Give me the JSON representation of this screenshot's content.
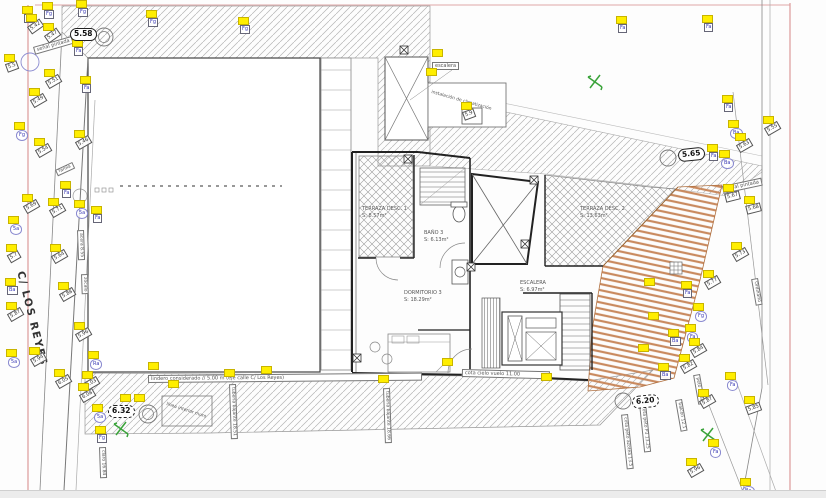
{
  "title": "Plano planta - levantamiento topográfico",
  "street": {
    "label": "C/ LOS REYES"
  },
  "rooms": [
    {
      "name": "TERRAZA DESC. 1",
      "area": "S: 8.57m²"
    },
    {
      "name": "BAÑO 3",
      "area": "S: 6.13m²"
    },
    {
      "name": "DORMITORIO 3",
      "area": "S: 18.29m²"
    },
    {
      "name": "ESCALERA",
      "area": "S: 6.97m²"
    },
    {
      "name": "TERRAZA DESC. 2",
      "area": "S: 13.63m²"
    }
  ],
  "benchmarks": [
    {
      "value": "5.58"
    },
    {
      "value": "5.65"
    },
    {
      "value": "6.32"
    },
    {
      "value": "6.20"
    }
  ],
  "colors": {
    "flag": "#ffee00",
    "deck": "#c98a5f",
    "station": "#3aa33a",
    "boundary": "#dc9a9a",
    "code_blue": "#3b3bb5"
  },
  "annotations": [
    {
      "t": "señal pintada",
      "x": 33,
      "y": 47,
      "r": -16,
      "box": 1,
      "fs": 5
    },
    {
      "t": "señal pintada",
      "x": 722,
      "y": 186,
      "r": -12,
      "box": 1,
      "fs": 5
    },
    {
      "t": "escalera",
      "x": 432,
      "y": 62,
      "r": 0,
      "box": 1,
      "fs": 5
    },
    {
      "t": "instalación de climatización",
      "x": 432,
      "y": 90,
      "r": 16,
      "box": 0,
      "fs": 4.5,
      "w": 66
    },
    {
      "t": "zócalo",
      "x": 88,
      "y": 274,
      "r": 88,
      "box": 1,
      "fs": 4.5
    },
    {
      "t": "farola",
      "x": 55,
      "y": 170,
      "r": -25,
      "box": 1,
      "fs": 4.5
    },
    {
      "t": "Ordinario",
      "x": 758,
      "y": 278,
      "r": 80,
      "box": 1,
      "fs": 4.5
    },
    {
      "t": "acera 8.55",
      "x": 84,
      "y": 230,
      "r": 88,
      "box": 1,
      "fs": 4.5
    },
    {
      "t": "lindero considerado // 5.00 m (eje calle C/ Los Reyes)",
      "x": 148,
      "y": 375,
      "r": -0.5,
      "box": 1,
      "fs": 5,
      "w": 268
    },
    {
      "t": "cota cielo vuelo 11.00",
      "x": 462,
      "y": 369,
      "r": 1.5,
      "box": 1,
      "fs": 5,
      "w": 82
    },
    {
      "t": "tubería bajante 18.51",
      "x": 236,
      "y": 384,
      "r": 88,
      "box": 1,
      "fs": 4.5
    },
    {
      "t": "tubería bajante 18.66",
      "x": 390,
      "y": 388,
      "r": 88,
      "box": 1,
      "fs": 4.5
    },
    {
      "t": "claro 16.84",
      "x": 106,
      "y": 447,
      "r": 88,
      "box": 1,
      "fs": 4.5
    },
    {
      "t": "cota peto azotea 13.5",
      "x": 628,
      "y": 414,
      "r": 84,
      "box": 1,
      "fs": 4.5
    },
    {
      "t": "cota peto P3 13.25",
      "x": 646,
      "y": 403,
      "r": 84,
      "box": 1,
      "fs": 4.5
    },
    {
      "t": "peto 12.38",
      "x": 700,
      "y": 374,
      "r": 80,
      "box": 1,
      "fs": 4.5
    },
    {
      "t": "balcón 12.1",
      "x": 682,
      "y": 399,
      "r": 80,
      "box": 1,
      "fs": 4.5
    },
    {
      "t": "línea interior muro",
      "x": 167,
      "y": 402,
      "r": 18,
      "box": 0,
      "fs": 4.5
    }
  ],
  "survey_points": [
    {
      "x": 24,
      "y": 14,
      "t": "Ba",
      "s": "code",
      "r": 0
    },
    {
      "x": 44,
      "y": 10,
      "t": "Fg",
      "s": "code",
      "r": 0
    },
    {
      "x": 78,
      "y": 8,
      "t": "Fg",
      "s": "code",
      "r": 0
    },
    {
      "x": 28,
      "y": 22,
      "t": "5.42",
      "s": "elev",
      "r": -35
    },
    {
      "x": 45,
      "y": 31,
      "t": "5.47",
      "s": "elev",
      "r": -35
    },
    {
      "x": 74,
      "y": 47,
      "t": "Fa",
      "s": "code",
      "r": 0
    },
    {
      "x": 6,
      "y": 62,
      "t": "5.5",
      "s": "elev",
      "r": -20
    },
    {
      "x": 46,
      "y": 77,
      "t": "5.51",
      "s": "elev",
      "r": -30
    },
    {
      "x": 82,
      "y": 84,
      "t": "Fa",
      "s": "code",
      "r": 0
    },
    {
      "x": 31,
      "y": 96,
      "t": "5.49",
      "s": "elev",
      "r": -30
    },
    {
      "x": 16,
      "y": 130,
      "t": "Fg",
      "s": "codeb",
      "r": 0
    },
    {
      "x": 76,
      "y": 138,
      "t": "5.46",
      "s": "elev",
      "r": -30
    },
    {
      "x": 36,
      "y": 146,
      "t": "5.54",
      "s": "elev",
      "r": -30
    },
    {
      "x": 62,
      "y": 189,
      "t": "Fa",
      "s": "code",
      "r": 0
    },
    {
      "x": 24,
      "y": 202,
      "t": "5.69",
      "s": "elev",
      "r": -30
    },
    {
      "x": 50,
      "y": 206,
      "t": "5.71",
      "s": "elev",
      "r": -30
    },
    {
      "x": 76,
      "y": 208,
      "t": "5a",
      "s": "codeb",
      "r": 0
    },
    {
      "x": 93,
      "y": 214,
      "t": "Fa",
      "s": "code",
      "r": 0
    },
    {
      "x": 10,
      "y": 224,
      "t": "5a",
      "s": "codeb",
      "r": 0
    },
    {
      "x": 8,
      "y": 252,
      "t": "5.7",
      "s": "elev",
      "r": -30
    },
    {
      "x": 52,
      "y": 252,
      "t": "5.64",
      "s": "elev",
      "r": -30
    },
    {
      "x": 7,
      "y": 286,
      "t": "Ba",
      "s": "code",
      "r": 0
    },
    {
      "x": 8,
      "y": 310,
      "t": "5.87",
      "s": "elev",
      "r": -30
    },
    {
      "x": 60,
      "y": 290,
      "t": "5.88",
      "s": "elev",
      "r": -30
    },
    {
      "x": 76,
      "y": 330,
      "t": "5.96",
      "s": "elev",
      "r": -30
    },
    {
      "x": 31,
      "y": 355,
      "t": "5.94",
      "s": "elev",
      "r": -30
    },
    {
      "x": 8,
      "y": 357,
      "t": "5a",
      "s": "codeb",
      "r": 0
    },
    {
      "x": 90,
      "y": 359,
      "t": "Ra",
      "s": "codeb",
      "r": 0
    },
    {
      "x": 56,
      "y": 377,
      "t": "6.05",
      "s": "elev",
      "r": -30
    },
    {
      "x": 84,
      "y": 379,
      "t": "6.03",
      "s": "elev",
      "r": -30
    },
    {
      "x": 80,
      "y": 391,
      "t": "6.08",
      "s": "elev",
      "r": -30
    },
    {
      "x": 94,
      "y": 412,
      "t": "5a",
      "s": "codeb",
      "r": 0
    },
    {
      "x": 97,
      "y": 434,
      "t": "Fg",
      "s": "code",
      "r": 0
    },
    {
      "x": 148,
      "y": 18,
      "t": "Fg",
      "s": "code",
      "r": 0
    },
    {
      "x": 240,
      "y": 25,
      "t": "Fg",
      "s": "code",
      "r": 0
    },
    {
      "x": 428,
      "y": 76,
      "t": "",
      "s": "flag"
    },
    {
      "x": 618,
      "y": 24,
      "t": "Fa",
      "s": "code",
      "r": 0
    },
    {
      "x": 704,
      "y": 23,
      "t": "Fa",
      "s": "code",
      "r": 0
    },
    {
      "x": 724,
      "y": 103,
      "t": "Fa",
      "s": "code",
      "r": 0
    },
    {
      "x": 765,
      "y": 124,
      "t": "5.55",
      "s": "elev",
      "r": -30
    },
    {
      "x": 730,
      "y": 128,
      "t": "Ba",
      "s": "codeb",
      "r": 0
    },
    {
      "x": 737,
      "y": 141,
      "t": "5.63",
      "s": "elev",
      "r": -30
    },
    {
      "x": 709,
      "y": 152,
      "t": "Fa",
      "s": "code",
      "r": 0
    },
    {
      "x": 721,
      "y": 158,
      "t": "Ba",
      "s": "codeb",
      "r": 0
    },
    {
      "x": 725,
      "y": 192,
      "t": "5.67",
      "s": "elev",
      "r": -14
    },
    {
      "x": 746,
      "y": 204,
      "t": "5.68",
      "s": "elev",
      "r": -14
    },
    {
      "x": 733,
      "y": 250,
      "t": "5.73",
      "s": "elev",
      "r": -30
    },
    {
      "x": 705,
      "y": 278,
      "t": "5.77",
      "s": "elev",
      "r": -30
    },
    {
      "x": 683,
      "y": 289,
      "t": "Fa",
      "s": "code",
      "r": 0
    },
    {
      "x": 695,
      "y": 311,
      "t": "Fg",
      "s": "codeb",
      "r": 0
    },
    {
      "x": 687,
      "y": 332,
      "t": "Fa",
      "s": "codeb",
      "r": 0
    },
    {
      "x": 670,
      "y": 337,
      "t": "Ba",
      "s": "code",
      "r": 0
    },
    {
      "x": 691,
      "y": 346,
      "t": "5.84",
      "s": "elev",
      "r": -30
    },
    {
      "x": 681,
      "y": 362,
      "t": "5.82",
      "s": "elev",
      "r": -30
    },
    {
      "x": 660,
      "y": 371,
      "t": "Ba",
      "s": "code",
      "r": 0
    },
    {
      "x": 727,
      "y": 380,
      "t": "Fa",
      "s": "codeb",
      "r": 0
    },
    {
      "x": 700,
      "y": 397,
      "t": "5.87",
      "s": "elev",
      "r": -30
    },
    {
      "x": 746,
      "y": 404,
      "t": "5.85",
      "s": "elev",
      "r": -20
    },
    {
      "x": 710,
      "y": 447,
      "t": "Fa",
      "s": "codeb",
      "r": 0
    },
    {
      "x": 688,
      "y": 466,
      "t": "5.96",
      "s": "elev",
      "r": -30
    },
    {
      "x": 742,
      "y": 486,
      "t": "Ba",
      "s": "codeb",
      "r": 0
    },
    {
      "x": 463,
      "y": 110,
      "t": "5.9",
      "s": "elev",
      "r": -20
    },
    {
      "x": 122,
      "y": 402,
      "t": "",
      "s": "flag"
    },
    {
      "x": 136,
      "y": 402,
      "t": "",
      "s": "flag"
    },
    {
      "x": 150,
      "y": 370,
      "t": "",
      "s": "flag"
    },
    {
      "x": 170,
      "y": 388,
      "t": "",
      "s": "flag"
    },
    {
      "x": 226,
      "y": 377,
      "t": "",
      "s": "flag"
    },
    {
      "x": 263,
      "y": 374,
      "t": "",
      "s": "flag"
    },
    {
      "x": 380,
      "y": 383,
      "t": "",
      "s": "flag"
    },
    {
      "x": 444,
      "y": 366,
      "t": "",
      "s": "flag"
    },
    {
      "x": 543,
      "y": 381,
      "t": "",
      "s": "flag"
    },
    {
      "x": 646,
      "y": 286,
      "t": "",
      "s": "flag"
    },
    {
      "x": 650,
      "y": 320,
      "t": "",
      "s": "flag"
    },
    {
      "x": 640,
      "y": 352,
      "t": "",
      "s": "flag"
    },
    {
      "x": 434,
      "y": 57,
      "t": "",
      "s": "flag"
    }
  ]
}
